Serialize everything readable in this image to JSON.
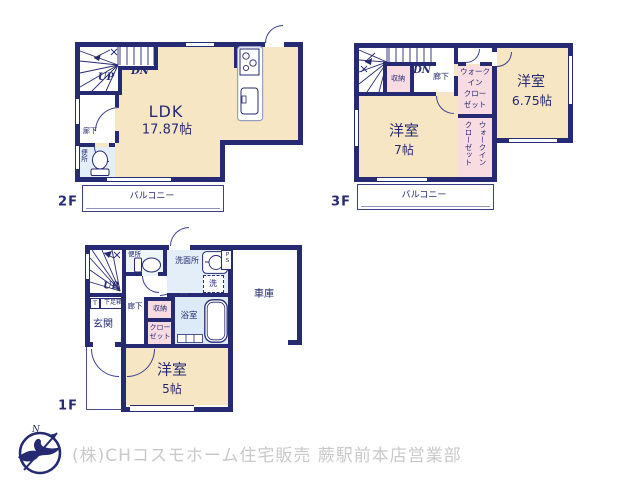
{
  "colors": {
    "wall": "#262a72",
    "room_cream": "#f6e6c4",
    "closet_pink": "#f9dce1",
    "wet_blue": "#e3eef9",
    "bath_blue": "#dcebf7",
    "footer_gray": "#c9c9c9"
  },
  "floor2": {
    "name": "2F",
    "ldk": "LDK",
    "ldk_size": "17.87帖",
    "up": "UP",
    "dn": "DN",
    "hallway": "廊下",
    "toilet": "便所",
    "balcony": "バルコニー"
  },
  "floor3": {
    "name": "3F",
    "dn": "DN",
    "storage": "収納",
    "hallway": "廊下",
    "room_left": "洋室",
    "room_left_size": "7帖",
    "room_right": "洋室",
    "room_right_size": "6.75帖",
    "wic1_l1": "ウォーク",
    "wic1_l2": "イン",
    "wic1_l3": "クロー",
    "wic1_l4": "ゼット",
    "wic2_c1": "ウォークイン",
    "wic2_c2": "クローゼット",
    "balcony": "バルコニー"
  },
  "floor1": {
    "name": "1F",
    "up": "UP",
    "toilet": "便所",
    "washroom": "洗面所",
    "washer": "洗",
    "ps": "PS",
    "bath": "浴室",
    "hallway": "廊下",
    "storage": "収納",
    "closet_l1": "クロー",
    "closet_l2": "ゼット",
    "entrance": "玄関",
    "shoe_t": "T",
    "shoe_box": "下足箱",
    "room": "洋室",
    "room_size": "5帖",
    "garage": "車庫"
  },
  "footer": {
    "company": "(株)CHコスモホーム住宅販売 蕨駅前本店営業部"
  }
}
